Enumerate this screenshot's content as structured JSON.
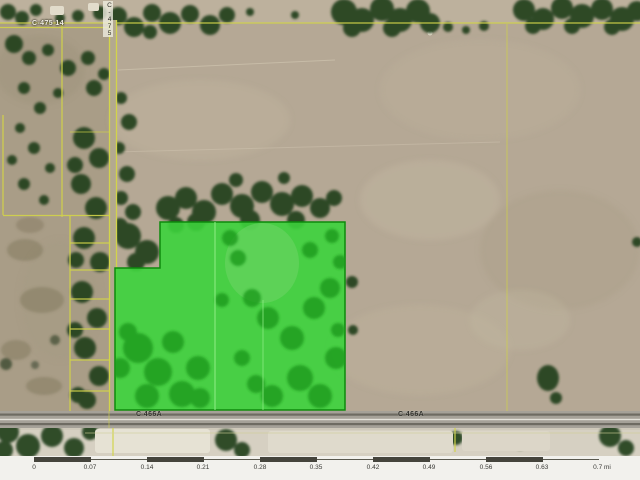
{
  "map": {
    "labels": {
      "top_road": "C-475 14",
      "vertical_road": "C-475",
      "highway_left": "C 466A",
      "highway_right": "C 466A"
    },
    "colors": {
      "highlight_green": "#3cd33c",
      "parcel_line_yellow": "#d2d44a",
      "field_tan": "#b5a895",
      "road_gray": "#a5a198"
    }
  },
  "scale_bar": {
    "labels": [
      "0",
      "0.07",
      "0.14",
      "0.21",
      "0.28",
      "0.35",
      "0.42",
      "0.49",
      "0.56",
      "0.63",
      "0.7 mi"
    ],
    "units": "mi",
    "segment_length_mi": 0.07,
    "bar_color": "#45443c"
  }
}
